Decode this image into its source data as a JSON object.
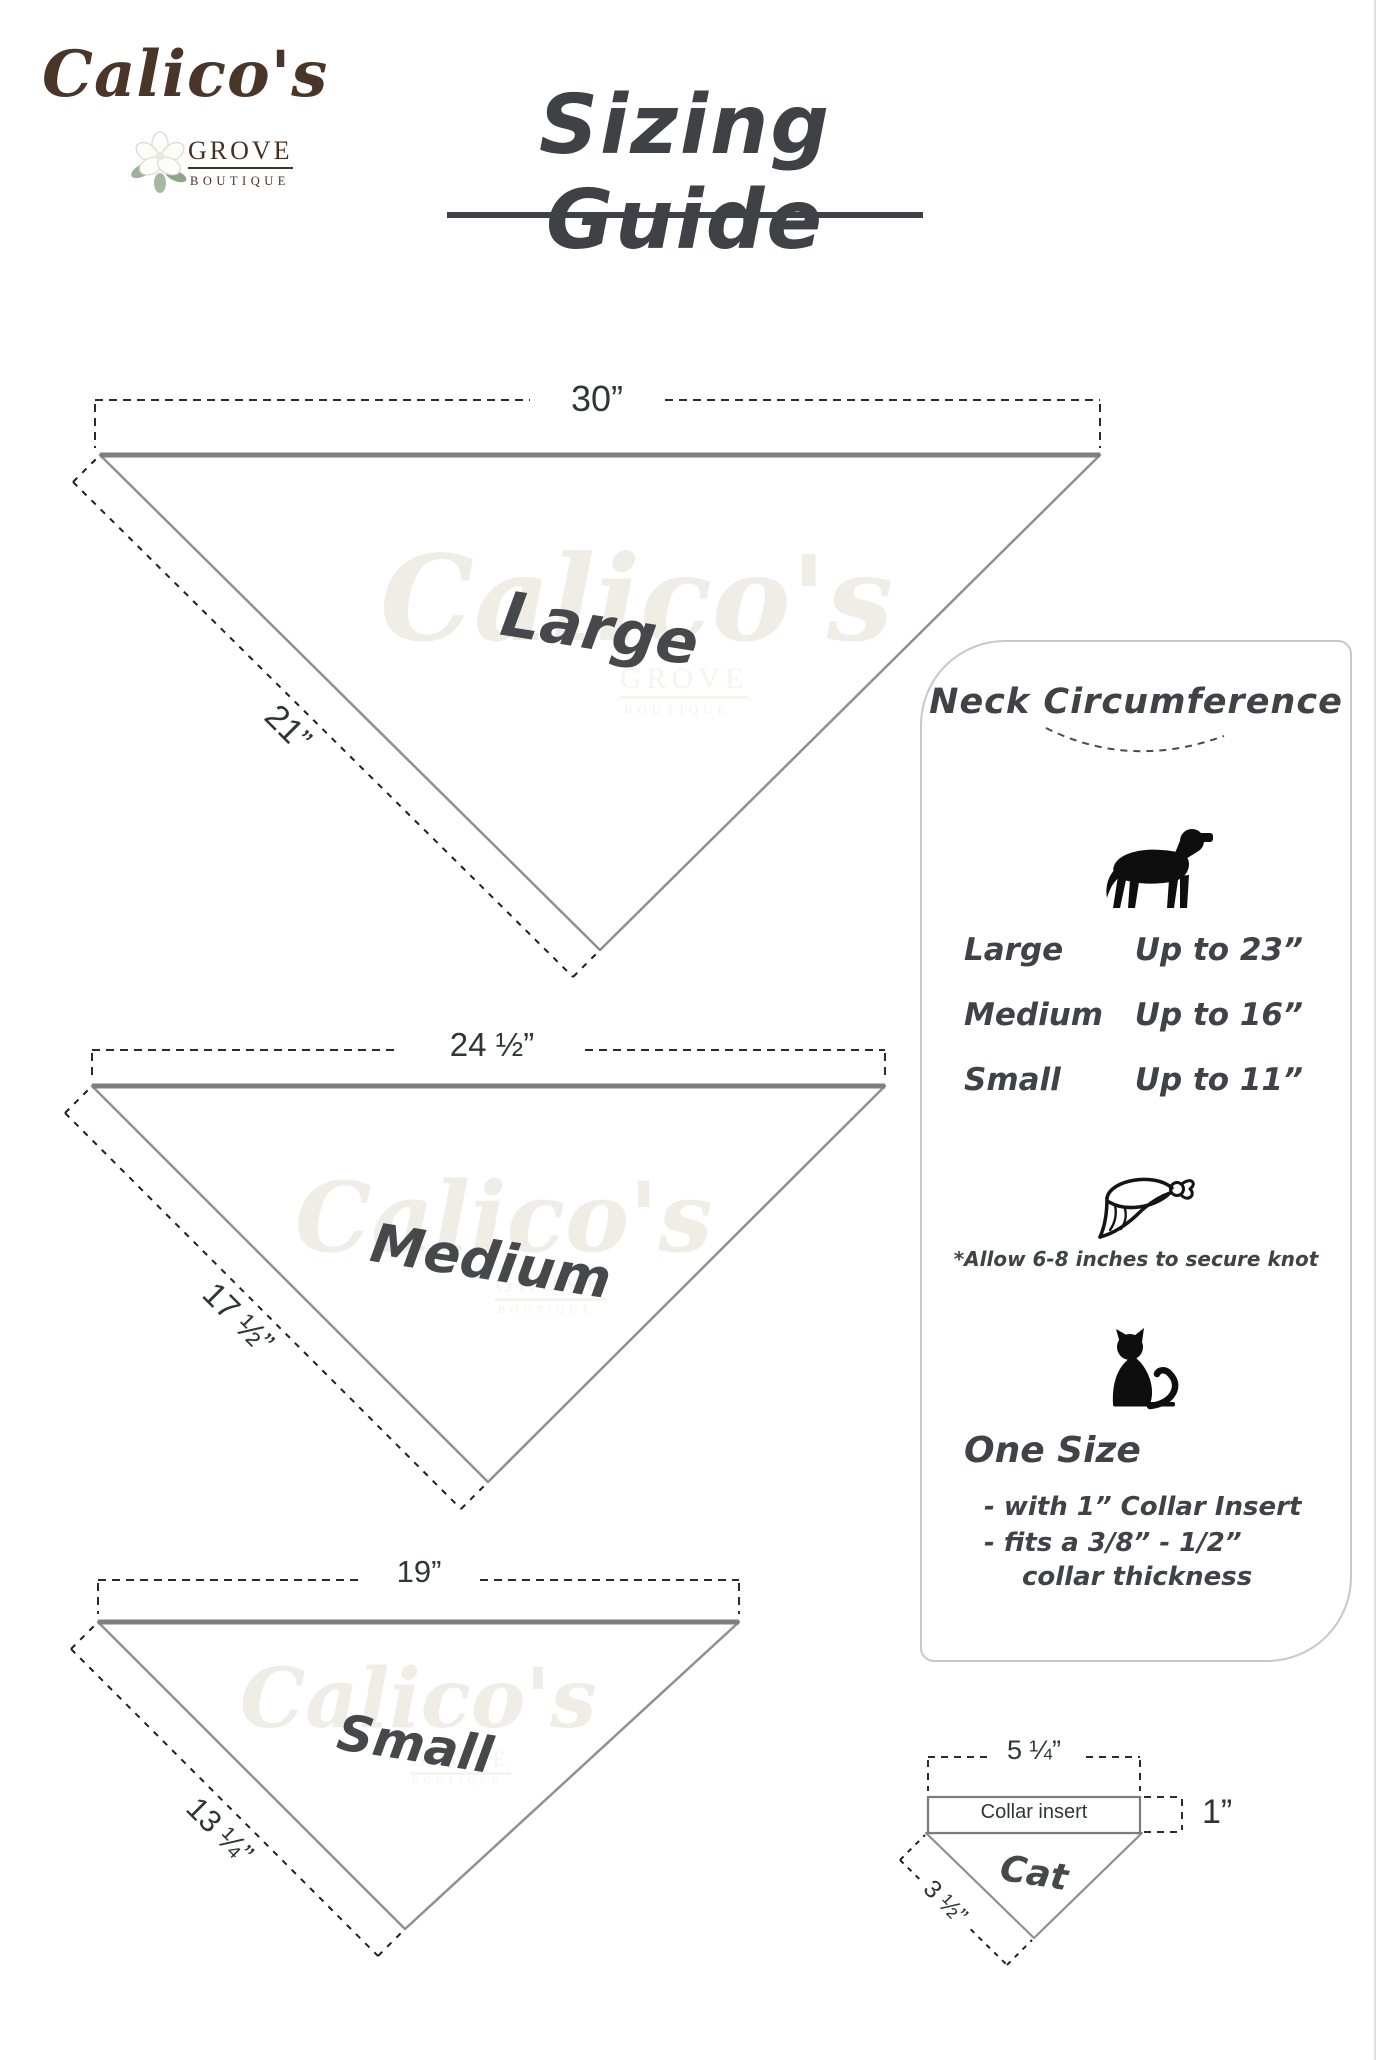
{
  "logo": {
    "name": "Calico's",
    "grove": "GROVE",
    "boutique": "BOUTIQUE"
  },
  "title": "Sizing Guide",
  "watermark": {
    "script": "Calico's",
    "grove": "GROVE",
    "boutique": "BOUTIQUE"
  },
  "bandanas": {
    "large": {
      "label": "Large",
      "top_width": "30”",
      "side_length": "21”"
    },
    "medium": {
      "label": "Medium",
      "top_width": "24 ½”",
      "side_length": "17 ½”"
    },
    "small": {
      "label": "Small",
      "top_width": "19”",
      "side_length": "13 ¼”"
    }
  },
  "panel": {
    "heading": "Neck Circumference",
    "dog_sizes": [
      {
        "size": "Large",
        "value": "Up to 23”"
      },
      {
        "size": "Medium",
        "value": "Up to 16”"
      },
      {
        "size": "Small",
        "value": "Up to 11”"
      }
    ],
    "knot_note": "*Allow 6-8 inches to secure knot",
    "cat_section": {
      "heading": "One Size",
      "line1": "- with 1” Collar Insert",
      "line2": "- fits a 3/8” - 1/2”",
      "line3": "collar thickness"
    }
  },
  "cat_diagram": {
    "top_width": "5 ¼”",
    "insert_label": "Collar insert",
    "insert_height": "1”",
    "label": "Cat",
    "side_length": "3 ½”"
  },
  "icons": {
    "dog": "dog-icon",
    "bandana": "bandana-icon",
    "cat": "cat-icon",
    "flower": "magnolia-flower-icon"
  },
  "colors": {
    "logo_brown": "#4a3629",
    "text_dark": "#3e4145",
    "triangle_line": "#8f8f8f",
    "dash_black": "#2b2b2b",
    "panel_border": "#c8c8c8",
    "watermark": "#f0ede7"
  }
}
